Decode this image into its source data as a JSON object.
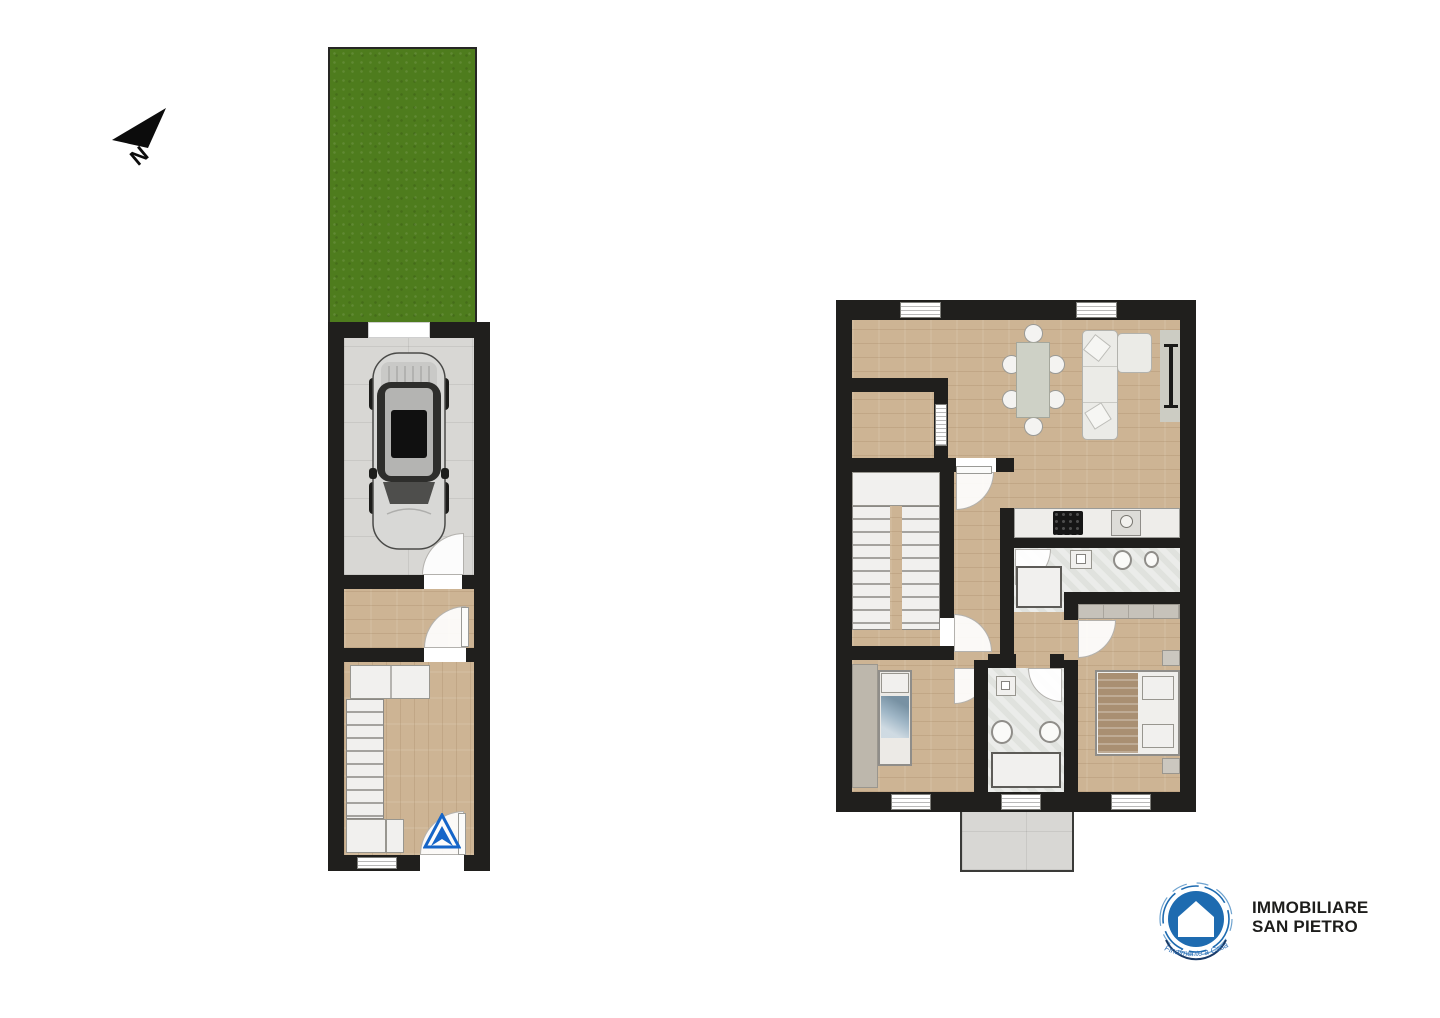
{
  "compass": {
    "label": "N"
  },
  "logo": {
    "title_line1": "IMMOBILIARE",
    "title_line2": "SAN PIETRO",
    "tagline": "Finalmente a Casa"
  },
  "colors": {
    "wall": "#201F1D",
    "wood": "#CDB494",
    "woodSeam": "#BA9E7A",
    "tile": "#D8D7D4",
    "bath": "#E0E2DE",
    "garden": "#4E7C1D",
    "furnWhite": "#F1F0EE",
    "furnBorder": "#98968F",
    "greyFurn": "#CBC7BF",
    "wardrobe": "#BDB7AC",
    "tableGrey": "#CED1C6",
    "blanketBlue": "#9FB6C6",
    "blanketBrown": "#A98F72",
    "logoBlue": "#1E6BB0",
    "arrowBlue": "#1565C8",
    "textDark": "#1D1D1B"
  },
  "plans": {
    "ground_floor": {
      "elements": [
        "garden",
        "garage",
        "car",
        "hallway",
        "staircase",
        "wardrobe",
        "cabinets",
        "entrance-door",
        "entrance-arrow",
        "window"
      ]
    },
    "first_floor": {
      "elements": [
        "living-dining-room",
        "dining-table",
        "six-chairs",
        "sofa",
        "sideboard-radiator",
        "staircase",
        "hallway",
        "kitchen-counter",
        "cooktop",
        "kitchen-sink",
        "bathroom",
        "shower",
        "toilet",
        "bidet",
        "wardrobe",
        "single-bedroom",
        "double-bedroom",
        "balcony",
        "windows"
      ]
    }
  }
}
